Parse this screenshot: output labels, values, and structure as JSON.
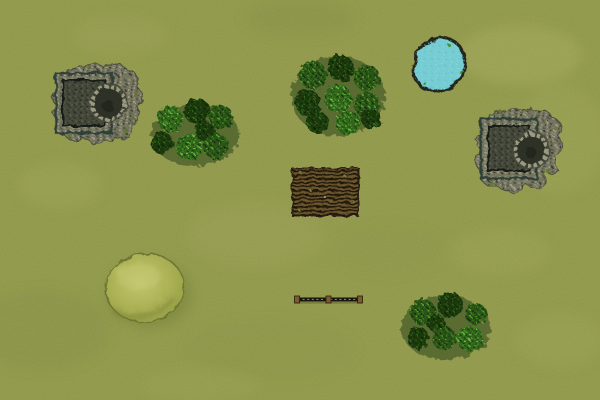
{
  "scene": {
    "kind": "top-down-battle-map",
    "description": "Top-down wargame battlefield on mottled green grass",
    "width": 600,
    "height": 400,
    "terrain": [
      {
        "id": "ruin-northwest",
        "type": "stone-ruin",
        "label": "Ruined walled keep with round tower",
        "x": 52,
        "y": 64,
        "width": 92,
        "height": 80
      },
      {
        "id": "forest-west",
        "type": "forest",
        "label": "Cluster of 7 trees",
        "x": 153,
        "y": 103,
        "width": 84,
        "height": 62
      },
      {
        "id": "forest-north",
        "type": "forest",
        "label": "Cluster of 9 trees",
        "x": 295,
        "y": 55,
        "width": 88,
        "height": 80
      },
      {
        "id": "pond-northeast",
        "type": "pond",
        "label": "Small pond with rocky edge",
        "x": 412,
        "y": 36,
        "width": 56,
        "height": 57
      },
      {
        "id": "ruin-east",
        "type": "stone-ruin",
        "label": "Ruined walled keep with round tower",
        "x": 476,
        "y": 110,
        "width": 86,
        "height": 84
      },
      {
        "id": "field-center",
        "type": "ploughed-field",
        "label": "Tilled brown field with furrows",
        "x": 292,
        "y": 168,
        "width": 67,
        "height": 48
      },
      {
        "id": "hill-southwest",
        "type": "hill",
        "label": "Low grassy oval hill",
        "x": 105,
        "y": 253,
        "width": 80,
        "height": 70
      },
      {
        "id": "fence-south",
        "type": "fence",
        "label": "Wooden fence rail with three posts",
        "x": 294,
        "y": 295,
        "width": 70,
        "height": 9
      },
      {
        "id": "forest-southeast",
        "type": "forest",
        "label": "Cluster of 7 trees",
        "x": 405,
        "y": 294,
        "width": 84,
        "height": 64
      }
    ]
  },
  "palette": {
    "grass": "#8b9342",
    "grass_light": "#b4b96a",
    "grass_dark": "#6f7c33",
    "tree_dark": "#1c3a0e",
    "tree_mid": "#2a5415",
    "tree_bright": "#3f7d22",
    "tree_highlight": "#5cb338",
    "stone": "#7c7c66",
    "stone_dark": "#45483a",
    "stone_light": "#9a9a82",
    "wall_edge": "#2d3f39",
    "water": "#74ccd2",
    "water_edge": "#23251b",
    "soil": "#5e4c26",
    "furrow_dark": "#271e10",
    "hill": "#adb357",
    "hill_light": "#c2c66e",
    "hill_edge": "#6e7533",
    "fence_rail": "#17150d",
    "fence_post": "#7c5c2c",
    "moss": "#647c2e"
  }
}
